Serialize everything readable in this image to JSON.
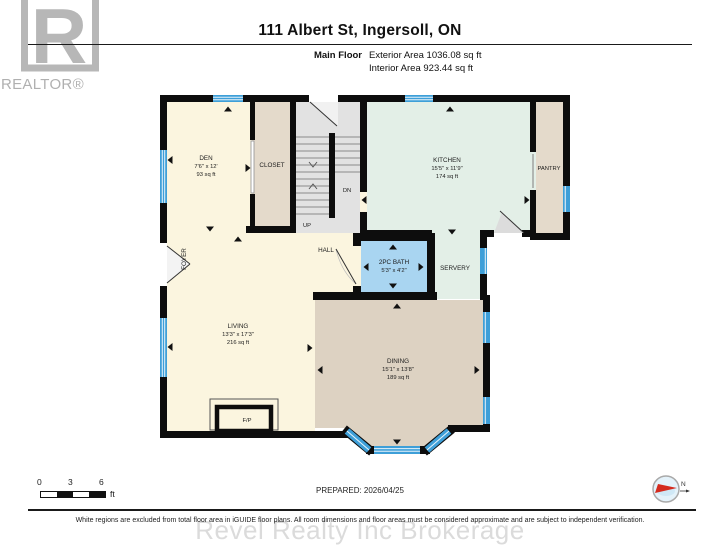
{
  "header": {
    "title": "111 Albert St, Ingersoll, ON",
    "floor_label": "Main Floor",
    "exterior_area": "Exterior Area 1036.08 sq ft",
    "interior_area": "Interior Area 923.44 sq ft"
  },
  "branding": {
    "realtor_r": "R",
    "realtor_wordmark": "REALTOR®",
    "watermark": "Revel Realty Inc Brokerage"
  },
  "plan": {
    "rooms": {
      "den": {
        "name": "DEN",
        "dims": "7'6\" x 12'",
        "area": "93 sq ft"
      },
      "closet": {
        "name": "CLOSET"
      },
      "kitchen": {
        "name": "KITCHEN",
        "dims": "15'5\" x 11'9\"",
        "area": "174 sq ft"
      },
      "pantry": {
        "name": "PANTRY"
      },
      "foyer": {
        "name": "FOYER"
      },
      "hall": {
        "name": "HALL"
      },
      "bath": {
        "name": "2PC BATH",
        "dims": "5'3\" x 4'2\""
      },
      "servery": {
        "name": "SERVERY"
      },
      "living": {
        "name": "LIVING",
        "dims": "13'3\" x 17'3\"",
        "area": "216 sq ft"
      },
      "dining": {
        "name": "DINING",
        "dims": "15'1\" x 13'8\"",
        "area": "189 sq ft"
      }
    },
    "stairs": {
      "up": "UP",
      "dn": "DN"
    },
    "fireplace_label": "F/P"
  },
  "footer": {
    "scale_ticks": [
      "0",
      "3",
      "6"
    ],
    "scale_unit": "ft",
    "prepared": "PREPARED: 2026/04/25",
    "compass_label": "N",
    "disclaimer": "White regions are excluded from total floor area in iGUIDE floor plans. All room dimensions and floor areas must be considered approximate and are subject to independent verification."
  },
  "colors": {
    "wall": "#0d0d0d",
    "floor_cream": "#FBF5DF",
    "floor_tan": "#E4DACB",
    "floor_dining": "#DDD2C2",
    "floor_mint": "#E3EFE7",
    "bath_blue": "#A9D5F1",
    "window_blue": "#3E9FD8",
    "stair_gray": "#E2E2E2"
  }
}
